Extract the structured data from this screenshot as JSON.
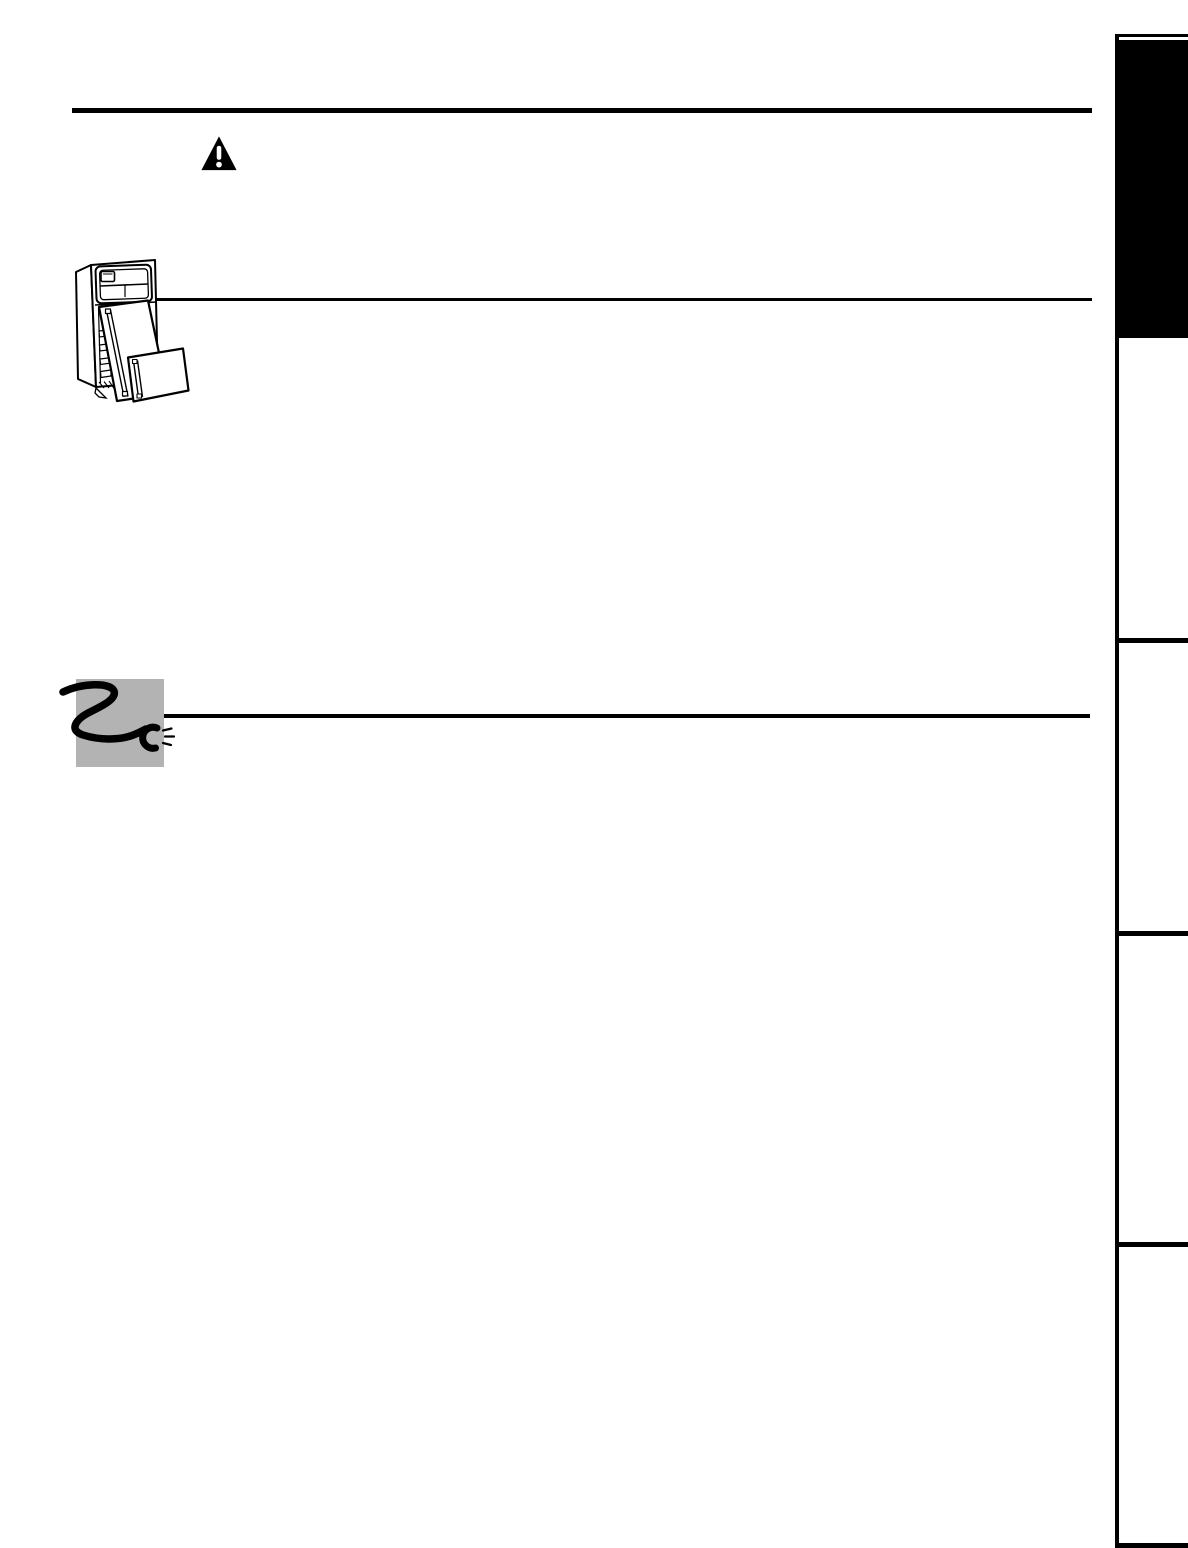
{
  "page": {
    "kind": "owner-manual-blank-template-page"
  },
  "colors": {
    "ink": "#000000",
    "paper": "#ffffff",
    "illustration_panel_gray": "#b3b3b3"
  },
  "icons": {
    "warning": {
      "name": "warning-triangle-icon",
      "glyph": "!"
    },
    "refrigerator": {
      "name": "refrigerator-doors-removed-illustration"
    },
    "power_cord": {
      "name": "power-cord-plug-illustration"
    }
  },
  "rules": {
    "count": 3,
    "names": [
      "top-heading-rule",
      "refrigerator-section-rule",
      "power-cord-section-rule"
    ]
  },
  "sidebar": {
    "tab_count": 5,
    "tabs": [
      {
        "name": "section-tab-1",
        "state": "active"
      },
      {
        "name": "section-tab-2",
        "state": "inactive"
      },
      {
        "name": "section-tab-3",
        "state": "inactive"
      },
      {
        "name": "section-tab-4",
        "state": "inactive"
      },
      {
        "name": "section-tab-5",
        "state": "inactive"
      }
    ]
  }
}
